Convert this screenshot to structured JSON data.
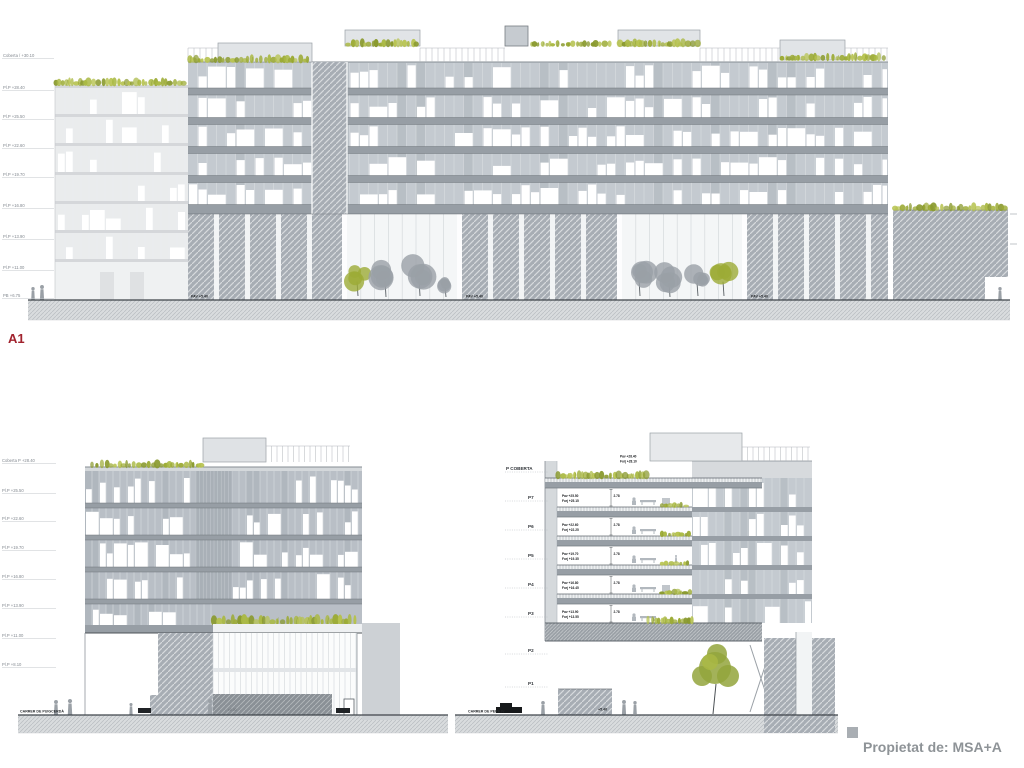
{
  "sheet": {
    "footer_label": "Propietat de: MSA+A"
  },
  "palette": {
    "vegetation_green": "#9cab36",
    "vegetation_light": "#aab944",
    "vegetation_dark": "#8a9a2f",
    "panel_gray": "#c4cad0",
    "slab_gray": "#979ea5",
    "silhouette_gray": "#9aa0a6",
    "marker_red": "#a1232e",
    "footer_gray": "#8e9397"
  },
  "top_elevation": {
    "section_label": "A1",
    "levels": [
      "Coberta / +30.10",
      "Pl.P +28.40",
      "Pl.P +25.50",
      "Pl.P +22.60",
      "Pl.P +19.70",
      "Pl.P +16.80",
      "Pl.P +13.90",
      "Pl.P +11.00",
      "PB +6.75"
    ],
    "ground_floor_label": "PAV +5.40"
  },
  "bottom_left_elevation": {
    "levels": [
      "Coberta P +28.40",
      "Pl.P +25.50",
      "Pl.P +22.60",
      "Pl.P +19.70",
      "Pl.P +16.80",
      "Pl.P +13.90",
      "Pl.P +11.00",
      "Pl.P +8.10"
    ],
    "street_label": "CARRER DE PUIGCERDÀ",
    "ground_note": "±0.00"
  },
  "bottom_right_section": {
    "floor_labels": [
      "P COBERTA",
      "P7",
      "P6",
      "P5",
      "P4",
      "P3",
      "P2",
      "P1"
    ],
    "roof_annotation": {
      "line1": "Pav +28.40",
      "line2": "Forj +28.10"
    },
    "floor_annotations": [
      {
        "line1": "Pav +25.50",
        "line2": "Forj +25.15",
        "height": "2.78"
      },
      {
        "line1": "Pav +22.60",
        "line2": "Forj +22.25",
        "height": "2.78"
      },
      {
        "line1": "Pav +19.70",
        "line2": "Forj +19.35",
        "height": "2.78"
      },
      {
        "line1": "Pav +16.80",
        "line2": "Forj +16.45",
        "height": "2.78"
      },
      {
        "line1": "Pav +13.90",
        "line2": "Forj +13.55",
        "height": "2.78"
      }
    ],
    "street_label": "CARRER DE PERE IV",
    "ground_note": "+5.40"
  }
}
